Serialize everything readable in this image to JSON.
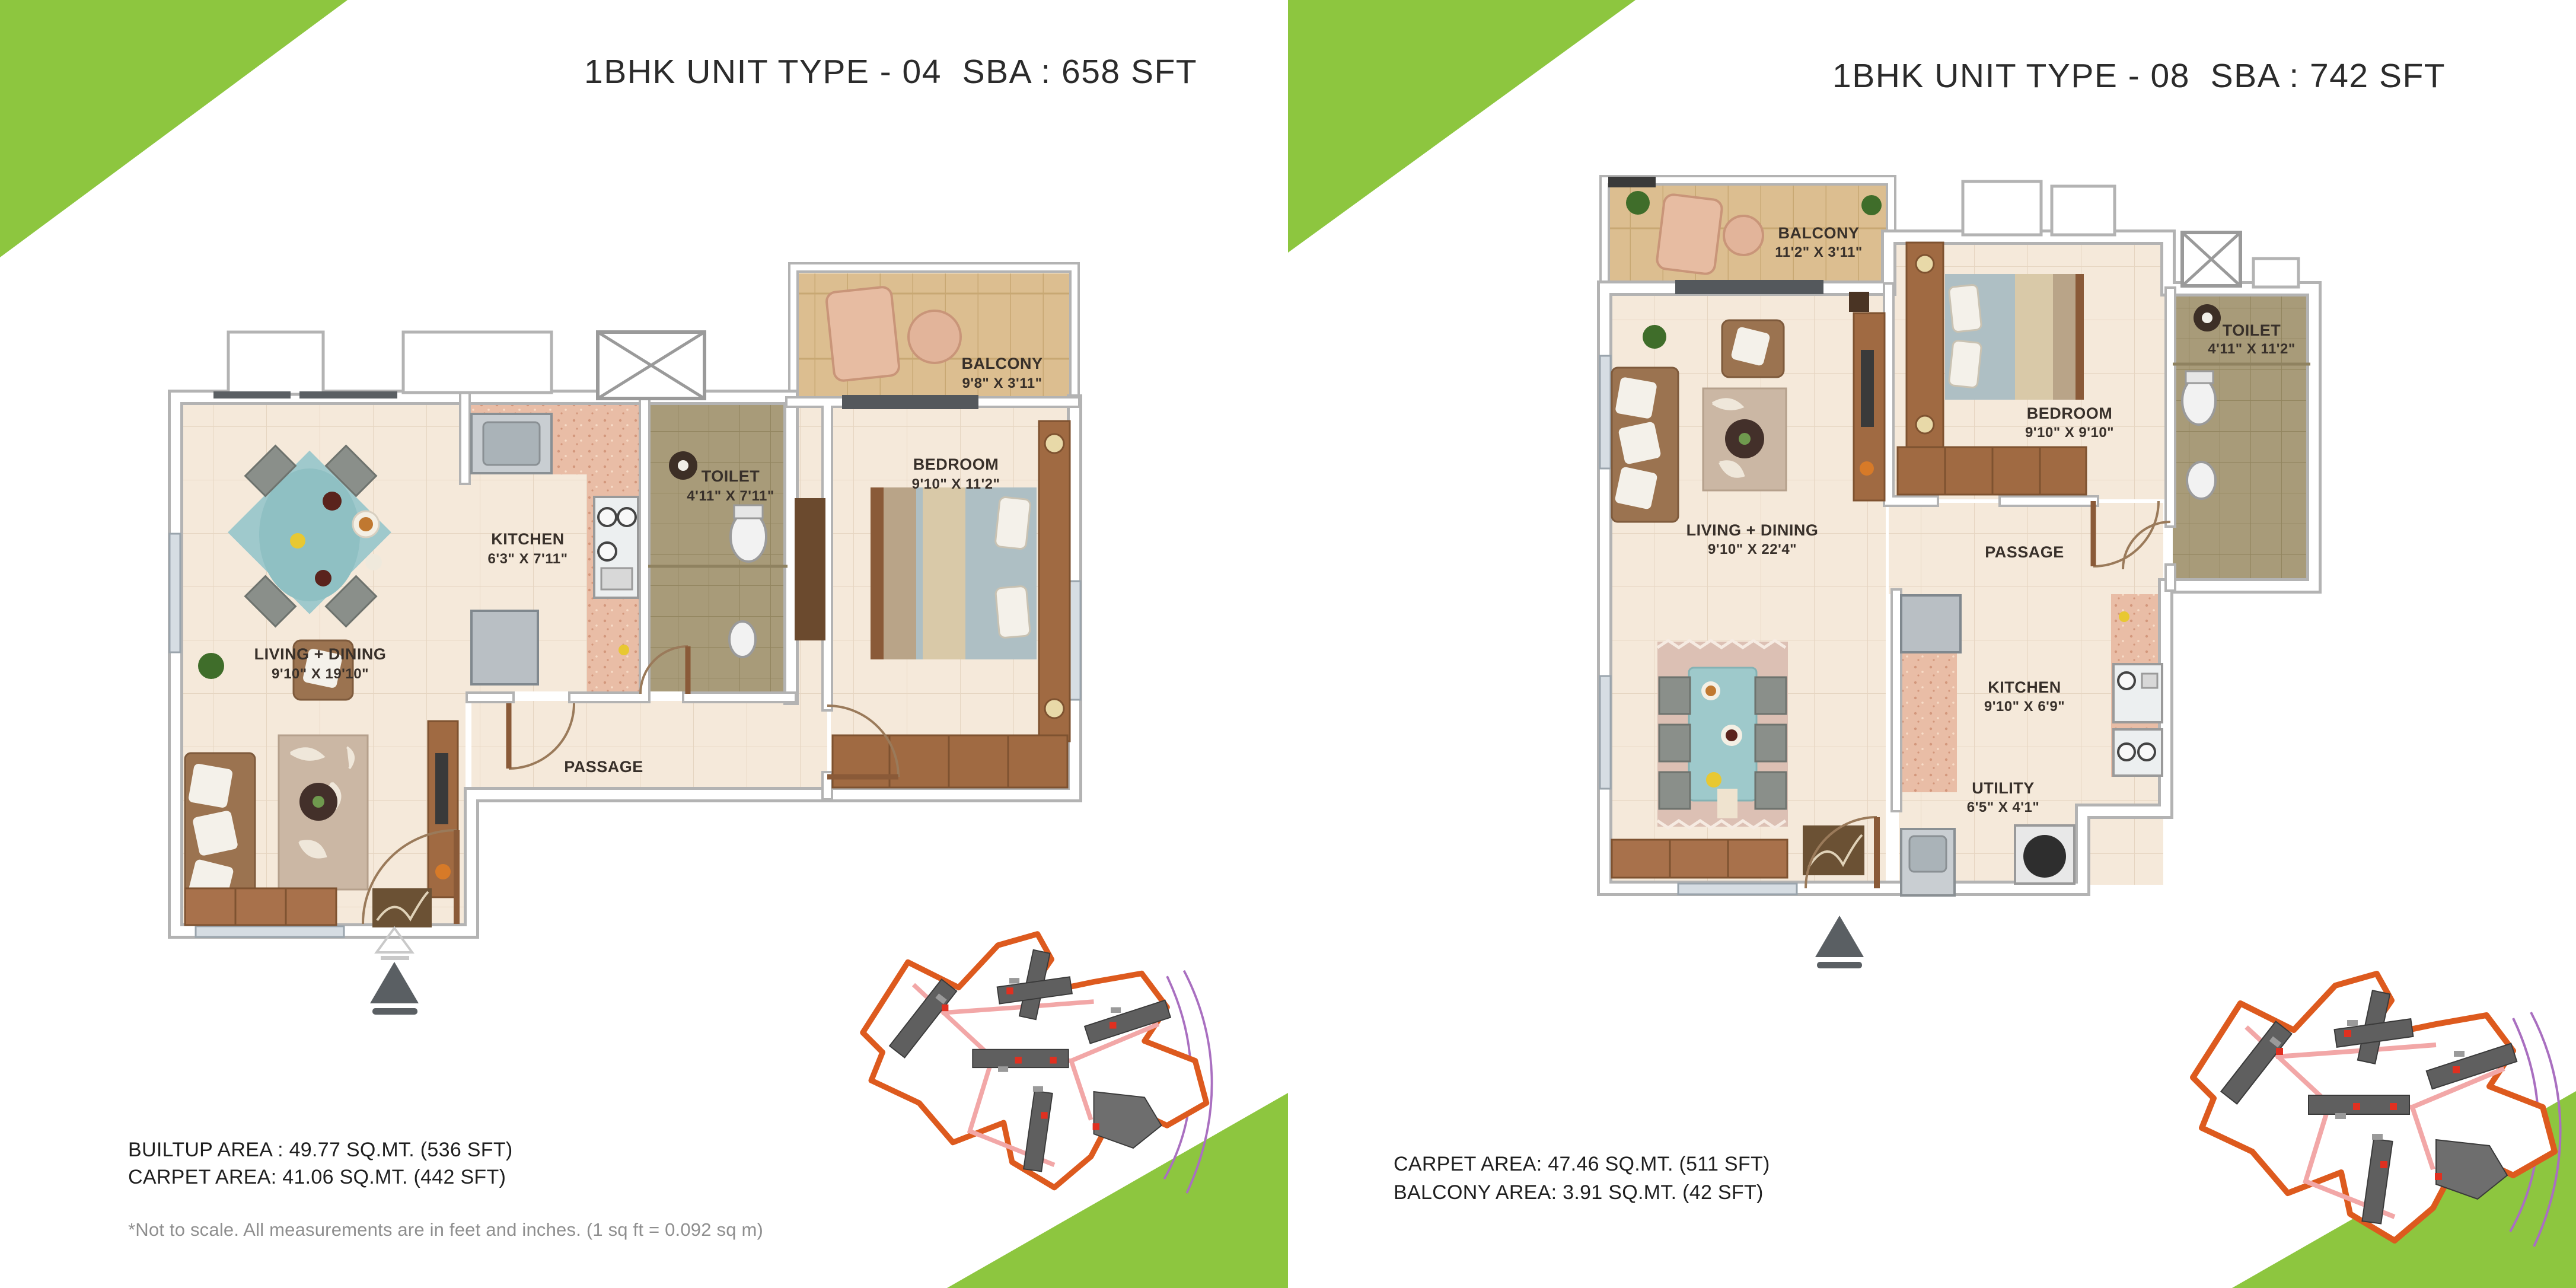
{
  "colors": {
    "accent_green": "#8dc63f",
    "title_text": "#2b2b2b",
    "label_text": "#38302a",
    "footnote_grey": "#8e8e8e",
    "siteplan_orange": "#dd5a1e",
    "floor_cream": "#f5e9da",
    "floor_wood": "#dcbe90",
    "floor_pink": "#e9bda6",
    "floor_olive": "#a89b79"
  },
  "left_page": {
    "title": "1BHK UNIT TYPE - 04  SBA : 658 SFT",
    "rooms": {
      "balcony": {
        "name": "BALCONY",
        "dims": "9'8\" X 3'11\""
      },
      "bedroom": {
        "name": "BEDROOM",
        "dims": "9'10\" X 11'2\""
      },
      "toilet": {
        "name": "TOILET",
        "dims": "4'11\" X 7'11\""
      },
      "kitchen": {
        "name": "KITCHEN",
        "dims": "6'3\" X 7'11\""
      },
      "living": {
        "name": "LIVING + DINING",
        "dims": "9'10\" X 19'10\""
      },
      "passage": {
        "name": "PASSAGE"
      }
    },
    "areas": {
      "line1": "BUILTUP AREA : 49.77 SQ.MT. (536 SFT)",
      "line2": "CARPET AREA: 41.06 SQ.MT. (442 SFT)"
    },
    "footnote": "*Not to scale. All measurements are in feet and inches. (1 sq ft = 0.092 sq m)"
  },
  "right_page": {
    "title": "1BHK UNIT TYPE - 08  SBA : 742 SFT",
    "rooms": {
      "balcony": {
        "name": "BALCONY",
        "dims": "11'2\" X 3'11\""
      },
      "bedroom": {
        "name": "BEDROOM",
        "dims": "9'10\" X 9'10\""
      },
      "toilet": {
        "name": "TOILET",
        "dims": "4'11\" X 11'2\""
      },
      "living": {
        "name": "LIVING + DINING",
        "dims": "9'10\" X 22'4\""
      },
      "passage": {
        "name": "PASSAGE"
      },
      "kitchen": {
        "name": "KITCHEN",
        "dims": "9'10\" X 6'9\""
      },
      "utility": {
        "name": "UTILITY",
        "dims": "6'5\" X 4'1\""
      }
    },
    "areas": {
      "line1": "CARPET AREA: 47.46 SQ.MT. (511 SFT)",
      "line2": "BALCONY AREA: 3.91 SQ.MT. (42 SFT)"
    }
  }
}
